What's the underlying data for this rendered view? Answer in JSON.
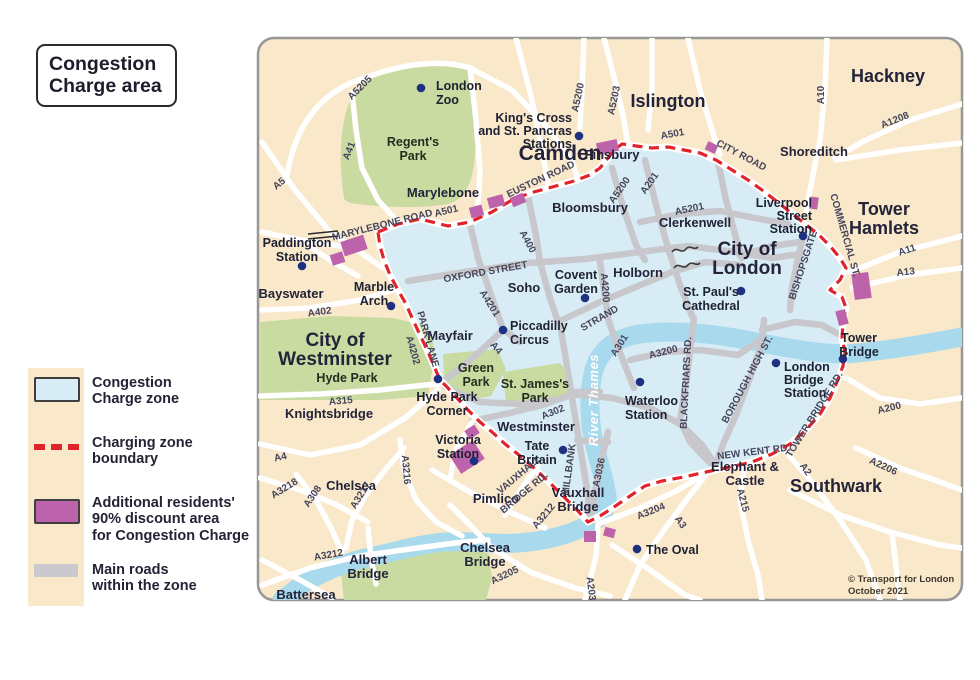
{
  "title_lines": [
    "Congestion",
    "Charge area"
  ],
  "legend": {
    "items": [
      {
        "name": "congestion-zone",
        "lines": [
          "Congestion",
          "Charge zone"
        ]
      },
      {
        "name": "charging-boundary",
        "lines": [
          "Charging zone",
          "boundary"
        ]
      },
      {
        "name": "discount-area",
        "lines": [
          "Additional residents'",
          "90% discount area",
          "for Congestion Charge"
        ]
      },
      {
        "name": "main-roads",
        "lines": [
          "Main roads",
          "within the zone"
        ]
      }
    ]
  },
  "colors": {
    "zone_fill": "#d8ecf5",
    "boundary_red": "#e3232b",
    "discount_purple": "#bd63ac",
    "main_road_gray": "#c7c7cc",
    "river_blue": "#a8d9ec",
    "park_green": "#c9dba1",
    "background_cream": "#f9e8c9",
    "station_dot_navy": "#1e3181"
  },
  "map": {
    "river_label": "River Thames",
    "copyright_lines": [
      "© Transport for London",
      "October 2021"
    ],
    "station_dots": [
      [
        421,
        88
      ],
      [
        579,
        136
      ],
      [
        302,
        266
      ],
      [
        391,
        306
      ],
      [
        503,
        330
      ],
      [
        585,
        298
      ],
      [
        438,
        379
      ],
      [
        474,
        461
      ],
      [
        563,
        450
      ],
      [
        640,
        382
      ],
      [
        741,
        291
      ],
      [
        803,
        236
      ],
      [
        776,
        363
      ],
      [
        843,
        359
      ],
      [
        637,
        549
      ]
    ],
    "discount_patches": [
      [
        342,
        238,
        24,
        15,
        -18
      ],
      [
        331,
        253,
        13,
        11,
        -18
      ],
      [
        470,
        206,
        13,
        11,
        -15
      ],
      [
        488,
        196,
        16,
        11,
        -15
      ],
      [
        511,
        195,
        14,
        10,
        -22
      ],
      [
        597,
        141,
        21,
        12,
        -12
      ],
      [
        706,
        143,
        11,
        9,
        25
      ],
      [
        810,
        197,
        8,
        12,
        8
      ],
      [
        853,
        273,
        17,
        26,
        -8
      ],
      [
        837,
        310,
        10,
        15,
        -15
      ],
      [
        453,
        446,
        28,
        22,
        -33
      ],
      [
        466,
        427,
        12,
        10,
        -33
      ],
      [
        584,
        531,
        12,
        11,
        0
      ],
      [
        604,
        528,
        11,
        9,
        15
      ]
    ],
    "labels": [
      {
        "t": "Camden",
        "x": 560,
        "y": 160,
        "s": 21,
        "c": "area"
      },
      {
        "t": "Islington",
        "x": 668,
        "y": 107,
        "s": 18,
        "c": "area"
      },
      {
        "t": "Hackney",
        "x": 888,
        "y": 82,
        "s": 18,
        "c": "area"
      },
      {
        "t": "Tower",
        "x": 884,
        "y": 215,
        "s": 18,
        "c": "area"
      },
      {
        "t": "Hamlets",
        "x": 884,
        "y": 234,
        "s": 18,
        "c": "area"
      },
      {
        "t": "City of",
        "x": 747,
        "y": 255,
        "s": 19,
        "c": "area"
      },
      {
        "t": "London",
        "x": 747,
        "y": 274,
        "s": 19,
        "c": "area"
      },
      {
        "t": "City of",
        "x": 335,
        "y": 346,
        "s": 19,
        "c": "area"
      },
      {
        "t": "Westminster",
        "x": 335,
        "y": 365,
        "s": 19,
        "c": "area"
      },
      {
        "t": "Southwark",
        "x": 836,
        "y": 492,
        "s": 18,
        "c": "area"
      },
      {
        "t": "Bayswater",
        "x": 291,
        "y": 298,
        "s": 13.5,
        "c": "town"
      },
      {
        "t": "Knightsbridge",
        "x": 329,
        "y": 418,
        "s": 13,
        "c": "town"
      },
      {
        "t": "Chelsea",
        "x": 351,
        "y": 490,
        "s": 13,
        "c": "town"
      },
      {
        "t": "Pimlico",
        "x": 496,
        "y": 503,
        "s": 13,
        "c": "town"
      },
      {
        "t": "Soho",
        "x": 524,
        "y": 292,
        "s": 13.5,
        "c": "town"
      },
      {
        "t": "Mayfair",
        "x": 450,
        "y": 340,
        "s": 13.5,
        "c": "town"
      },
      {
        "t": "Marylebone",
        "x": 443,
        "y": 197,
        "s": 13.5,
        "c": "town"
      },
      {
        "t": "Bloomsbury",
        "x": 590,
        "y": 212,
        "s": 12.5,
        "c": "town"
      },
      {
        "t": "Clerkenwell",
        "x": 695,
        "y": 227,
        "s": 12.5,
        "c": "town"
      },
      {
        "t": "Finsbury",
        "x": 612,
        "y": 159,
        "s": 12.5,
        "c": "town"
      },
      {
        "t": "Holborn",
        "x": 638,
        "y": 277,
        "s": 13.5,
        "c": "town"
      },
      {
        "t": "Shoreditch",
        "x": 814,
        "y": 156,
        "s": 12.5,
        "c": "town"
      },
      {
        "t": "Battersea",
        "x": 306,
        "y": 599,
        "s": 12.5,
        "c": "town"
      },
      {
        "t": "Westminster",
        "x": 536,
        "y": 431,
        "s": 12.5,
        "c": "town"
      },
      {
        "t": "Elephant &",
        "x": 745,
        "y": 471,
        "s": 12.5,
        "c": "town"
      },
      {
        "t": "Castle",
        "x": 745,
        "y": 485,
        "s": 12.5,
        "c": "town"
      },
      {
        "t": "Vauxhall",
        "x": 578,
        "y": 497,
        "s": 12.5,
        "c": "town"
      },
      {
        "t": "Bridge",
        "x": 578,
        "y": 511,
        "s": 12.5,
        "c": "town"
      },
      {
        "t": "Chelsea",
        "x": 485,
        "y": 552,
        "s": 12.5,
        "c": "town"
      },
      {
        "t": "Bridge",
        "x": 485,
        "y": 566,
        "s": 12.5,
        "c": "town"
      },
      {
        "t": "Albert",
        "x": 368,
        "y": 564,
        "s": 12.5,
        "c": "town"
      },
      {
        "t": "Bridge",
        "x": 368,
        "y": 578,
        "s": 12.5,
        "c": "town"
      },
      {
        "t": "Regent's",
        "x": 413,
        "y": 146,
        "c": "park"
      },
      {
        "t": "Park",
        "x": 413,
        "y": 160,
        "c": "park"
      },
      {
        "t": "Hyde Park",
        "x": 347,
        "y": 382,
        "c": "park"
      },
      {
        "t": "Green",
        "x": 476,
        "y": 372,
        "s": 12,
        "c": "park"
      },
      {
        "t": "Park",
        "x": 476,
        "y": 386,
        "s": 12,
        "c": "park"
      },
      {
        "t": "St. James's",
        "x": 535,
        "y": 388,
        "s": 12,
        "c": "park"
      },
      {
        "t": "Park",
        "x": 535,
        "y": 402,
        "s": 12,
        "c": "park"
      },
      {
        "t": "London",
        "x": 436,
        "y": 90,
        "a": "start",
        "c": "poi"
      },
      {
        "t": "Zoo",
        "x": 436,
        "y": 104,
        "a": "start",
        "c": "poi"
      },
      {
        "t": "King's Cross",
        "x": 572,
        "y": 122,
        "a": "end",
        "c": "poi"
      },
      {
        "t": "and St. Pancras",
        "x": 572,
        "y": 135,
        "a": "end",
        "c": "poi"
      },
      {
        "t": "Stations",
        "x": 572,
        "y": 148,
        "a": "end",
        "c": "poi"
      },
      {
        "t": "Paddington",
        "x": 297,
        "y": 247,
        "c": "poi"
      },
      {
        "t": "Station",
        "x": 297,
        "y": 261,
        "c": "poi"
      },
      {
        "t": "Marble",
        "x": 374,
        "y": 291,
        "c": "poi"
      },
      {
        "t": "Arch",
        "x": 374,
        "y": 305,
        "c": "poi"
      },
      {
        "t": "Piccadilly",
        "x": 510,
        "y": 330,
        "a": "start",
        "c": "poi"
      },
      {
        "t": "Circus",
        "x": 510,
        "y": 344,
        "a": "start",
        "c": "poi"
      },
      {
        "t": "Covent",
        "x": 576,
        "y": 279,
        "c": "poi"
      },
      {
        "t": "Garden",
        "x": 576,
        "y": 293,
        "c": "poi"
      },
      {
        "t": "Hyde Park",
        "x": 447,
        "y": 401,
        "c": "poi"
      },
      {
        "t": "Corner",
        "x": 447,
        "y": 415,
        "c": "poi"
      },
      {
        "t": "Victoria",
        "x": 458,
        "y": 444,
        "c": "poi"
      },
      {
        "t": "Station",
        "x": 458,
        "y": 458,
        "c": "poi"
      },
      {
        "t": "Tate",
        "x": 537,
        "y": 450,
        "c": "poi"
      },
      {
        "t": "Britain",
        "x": 537,
        "y": 464,
        "c": "poi"
      },
      {
        "t": "Waterloo",
        "x": 625,
        "y": 405,
        "a": "start",
        "c": "poi"
      },
      {
        "t": "Station",
        "x": 625,
        "y": 419,
        "a": "start",
        "c": "poi"
      },
      {
        "t": "St. Paul's",
        "x": 711,
        "y": 296,
        "c": "poi"
      },
      {
        "t": "Cathedral",
        "x": 711,
        "y": 310,
        "c": "poi"
      },
      {
        "t": "Liverpool",
        "x": 812,
        "y": 207,
        "a": "end",
        "c": "poi"
      },
      {
        "t": "Street",
        "x": 812,
        "y": 220,
        "a": "end",
        "c": "poi"
      },
      {
        "t": "Station",
        "x": 812,
        "y": 233,
        "a": "end",
        "c": "poi"
      },
      {
        "t": "London",
        "x": 784,
        "y": 371,
        "a": "start",
        "c": "poi"
      },
      {
        "t": "Bridge",
        "x": 784,
        "y": 384,
        "a": "start",
        "c": "poi"
      },
      {
        "t": "Station",
        "x": 784,
        "y": 397,
        "a": "start",
        "c": "poi"
      },
      {
        "t": "Tower",
        "x": 859,
        "y": 342,
        "c": "poi"
      },
      {
        "t": "Bridge",
        "x": 859,
        "y": 356,
        "c": "poi"
      },
      {
        "t": "The Oval",
        "x": 646,
        "y": 554,
        "a": "start",
        "c": "poi"
      },
      {
        "t": "A5205",
        "x": 362,
        "y": 90,
        "r": -45,
        "c": "road"
      },
      {
        "t": "A41",
        "x": 352,
        "y": 152,
        "r": -68,
        "c": "road"
      },
      {
        "t": "A5",
        "x": 281,
        "y": 186,
        "r": -38,
        "c": "road"
      },
      {
        "t": "MARYLEBONE ROAD",
        "x": 383,
        "y": 228,
        "r": -14,
        "c": "road"
      },
      {
        "t": "A501",
        "x": 447,
        "y": 214,
        "r": -14,
        "c": "road"
      },
      {
        "t": "EUSTON ROAD",
        "x": 542,
        "y": 182,
        "r": -25,
        "c": "road"
      },
      {
        "t": "A5200",
        "x": 581,
        "y": 98,
        "r": -78,
        "c": "road"
      },
      {
        "t": "A5203",
        "x": 617,
        "y": 101,
        "r": -78,
        "c": "road"
      },
      {
        "t": "A501",
        "x": 673,
        "y": 137,
        "r": -10,
        "c": "road"
      },
      {
        "t": "CITY ROAD",
        "x": 740,
        "y": 158,
        "r": 28,
        "c": "road"
      },
      {
        "t": "A10",
        "x": 824,
        "y": 95,
        "r": -90,
        "c": "road"
      },
      {
        "t": "A1208",
        "x": 896,
        "y": 123,
        "r": -22,
        "c": "road"
      },
      {
        "t": "A11",
        "x": 908,
        "y": 253,
        "r": -18,
        "c": "road"
      },
      {
        "t": "A13",
        "x": 906,
        "y": 275,
        "r": -6,
        "c": "road"
      },
      {
        "t": "COMMERCIAL ST.",
        "x": 842,
        "y": 236,
        "r": 74,
        "c": "road"
      },
      {
        "t": "BISHOPSGATE",
        "x": 806,
        "y": 266,
        "r": -72,
        "c": "road"
      },
      {
        "t": "A5200",
        "x": 622,
        "y": 192,
        "r": -55,
        "c": "road"
      },
      {
        "t": "A201",
        "x": 652,
        "y": 185,
        "r": -55,
        "c": "road"
      },
      {
        "t": "A5201",
        "x": 690,
        "y": 212,
        "r": -12,
        "c": "road"
      },
      {
        "t": "OXFORD STREET",
        "x": 486,
        "y": 275,
        "r": -10,
        "c": "road"
      },
      {
        "t": "A400",
        "x": 525,
        "y": 243,
        "r": 62,
        "c": "road"
      },
      {
        "t": "A4201",
        "x": 487,
        "y": 305,
        "r": 58,
        "c": "road"
      },
      {
        "t": "A4200",
        "x": 602,
        "y": 288,
        "r": 85,
        "c": "road"
      },
      {
        "t": "A4",
        "x": 494,
        "y": 350,
        "r": 48,
        "c": "road"
      },
      {
        "t": "STRAND",
        "x": 601,
        "y": 321,
        "r": -30,
        "c": "road"
      },
      {
        "t": "A301",
        "x": 622,
        "y": 347,
        "r": -58,
        "c": "road"
      },
      {
        "t": "A3200",
        "x": 664,
        "y": 355,
        "r": -14,
        "c": "road"
      },
      {
        "t": "BLACKFRIARS RD.",
        "x": 689,
        "y": 383,
        "r": -87,
        "c": "road"
      },
      {
        "t": "BOROUGH HIGH ST.",
        "x": 750,
        "y": 381,
        "r": -62,
        "c": "road"
      },
      {
        "t": "TOWER BRIDGE RD.",
        "x": 817,
        "y": 416,
        "r": -58,
        "c": "road"
      },
      {
        "t": "NEW KENT RD.",
        "x": 754,
        "y": 455,
        "r": -7,
        "c": "road"
      },
      {
        "t": "A200",
        "x": 890,
        "y": 411,
        "r": -14,
        "c": "road"
      },
      {
        "t": "A2206",
        "x": 882,
        "y": 469,
        "r": 25,
        "c": "road"
      },
      {
        "t": "A2",
        "x": 803,
        "y": 471,
        "r": 55,
        "c": "road"
      },
      {
        "t": "A215",
        "x": 740,
        "y": 501,
        "r": 75,
        "c": "road"
      },
      {
        "t": "A3",
        "x": 678,
        "y": 524,
        "r": 55,
        "c": "road"
      },
      {
        "t": "A3204",
        "x": 652,
        "y": 514,
        "r": -22,
        "c": "road"
      },
      {
        "t": "A315",
        "x": 341,
        "y": 404,
        "r": -5,
        "c": "road"
      },
      {
        "t": "A4",
        "x": 281,
        "y": 460,
        "r": -12,
        "c": "road"
      },
      {
        "t": "A402",
        "x": 320,
        "y": 315,
        "r": -8,
        "c": "road"
      },
      {
        "t": "A3218",
        "x": 286,
        "y": 491,
        "r": -32,
        "c": "road"
      },
      {
        "t": "A308",
        "x": 315,
        "y": 498,
        "r": -56,
        "c": "road"
      },
      {
        "t": "A3217",
        "x": 363,
        "y": 497,
        "r": -58,
        "c": "road"
      },
      {
        "t": "A3216",
        "x": 403,
        "y": 470,
        "r": 85,
        "c": "road"
      },
      {
        "t": "PARK LANE",
        "x": 425,
        "y": 340,
        "r": 74,
        "c": "road"
      },
      {
        "t": "A4202",
        "x": 410,
        "y": 351,
        "r": 74,
        "c": "road"
      },
      {
        "t": "VAUXHALL",
        "x": 521,
        "y": 477,
        "r": -40,
        "c": "road"
      },
      {
        "t": "BRIDGE RD.",
        "x": 526,
        "y": 495,
        "r": -40,
        "c": "road"
      },
      {
        "t": "MILLBANK",
        "x": 572,
        "y": 470,
        "r": -82,
        "c": "road"
      },
      {
        "t": "A3036",
        "x": 602,
        "y": 473,
        "r": -78,
        "c": "road"
      },
      {
        "t": "A302",
        "x": 554,
        "y": 415,
        "r": -22,
        "c": "road"
      },
      {
        "t": "A3212",
        "x": 546,
        "y": 518,
        "r": -50,
        "c": "road"
      },
      {
        "t": "A3212",
        "x": 329,
        "y": 558,
        "r": -10,
        "c": "road"
      },
      {
        "t": "A3205",
        "x": 506,
        "y": 578,
        "r": -26,
        "c": "road"
      },
      {
        "t": "A203",
        "x": 588,
        "y": 589,
        "r": 83,
        "c": "road"
      },
      {
        "t": "River Thames",
        "x": 598,
        "y": 400,
        "r": -90,
        "c": "river"
      },
      {
        "t": "© Transport for London",
        "x": 848,
        "y": 582,
        "a": "start",
        "c": "copy"
      },
      {
        "t": "October 2021",
        "x": 848,
        "y": 594,
        "a": "start",
        "c": "copy"
      }
    ]
  }
}
